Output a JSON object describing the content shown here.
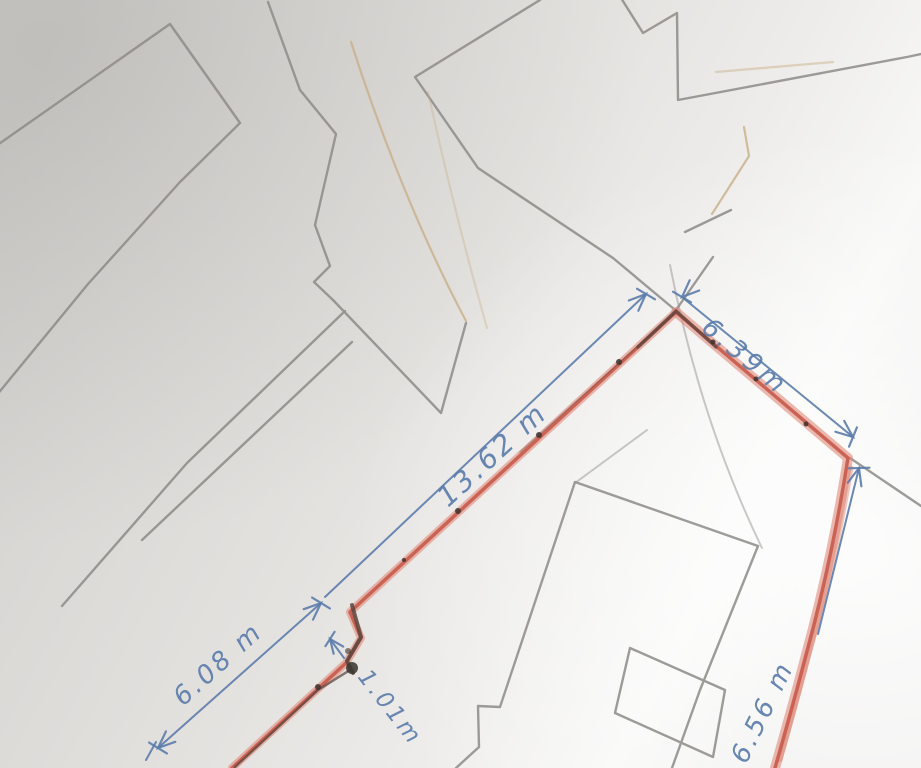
{
  "sketch": {
    "description": "Hand-drawn land parcel survey sketch with red boundary and blue dimensions",
    "dimension_labels": {
      "d13_62": "13.62 m",
      "d6_39": "6.39m",
      "d6_56": "6.56 m",
      "d6_08": "6.08 m",
      "d1_01": "1.01m"
    },
    "colors": {
      "paper": "#e4e2df",
      "pencil": "#8d8b87",
      "tan_pencil": "#c8af89",
      "red_marker": "#c85a4b",
      "red_halo": "#e08a7c",
      "blue_ink": "#5b7cab",
      "dark_pencil": "#52423a"
    }
  }
}
